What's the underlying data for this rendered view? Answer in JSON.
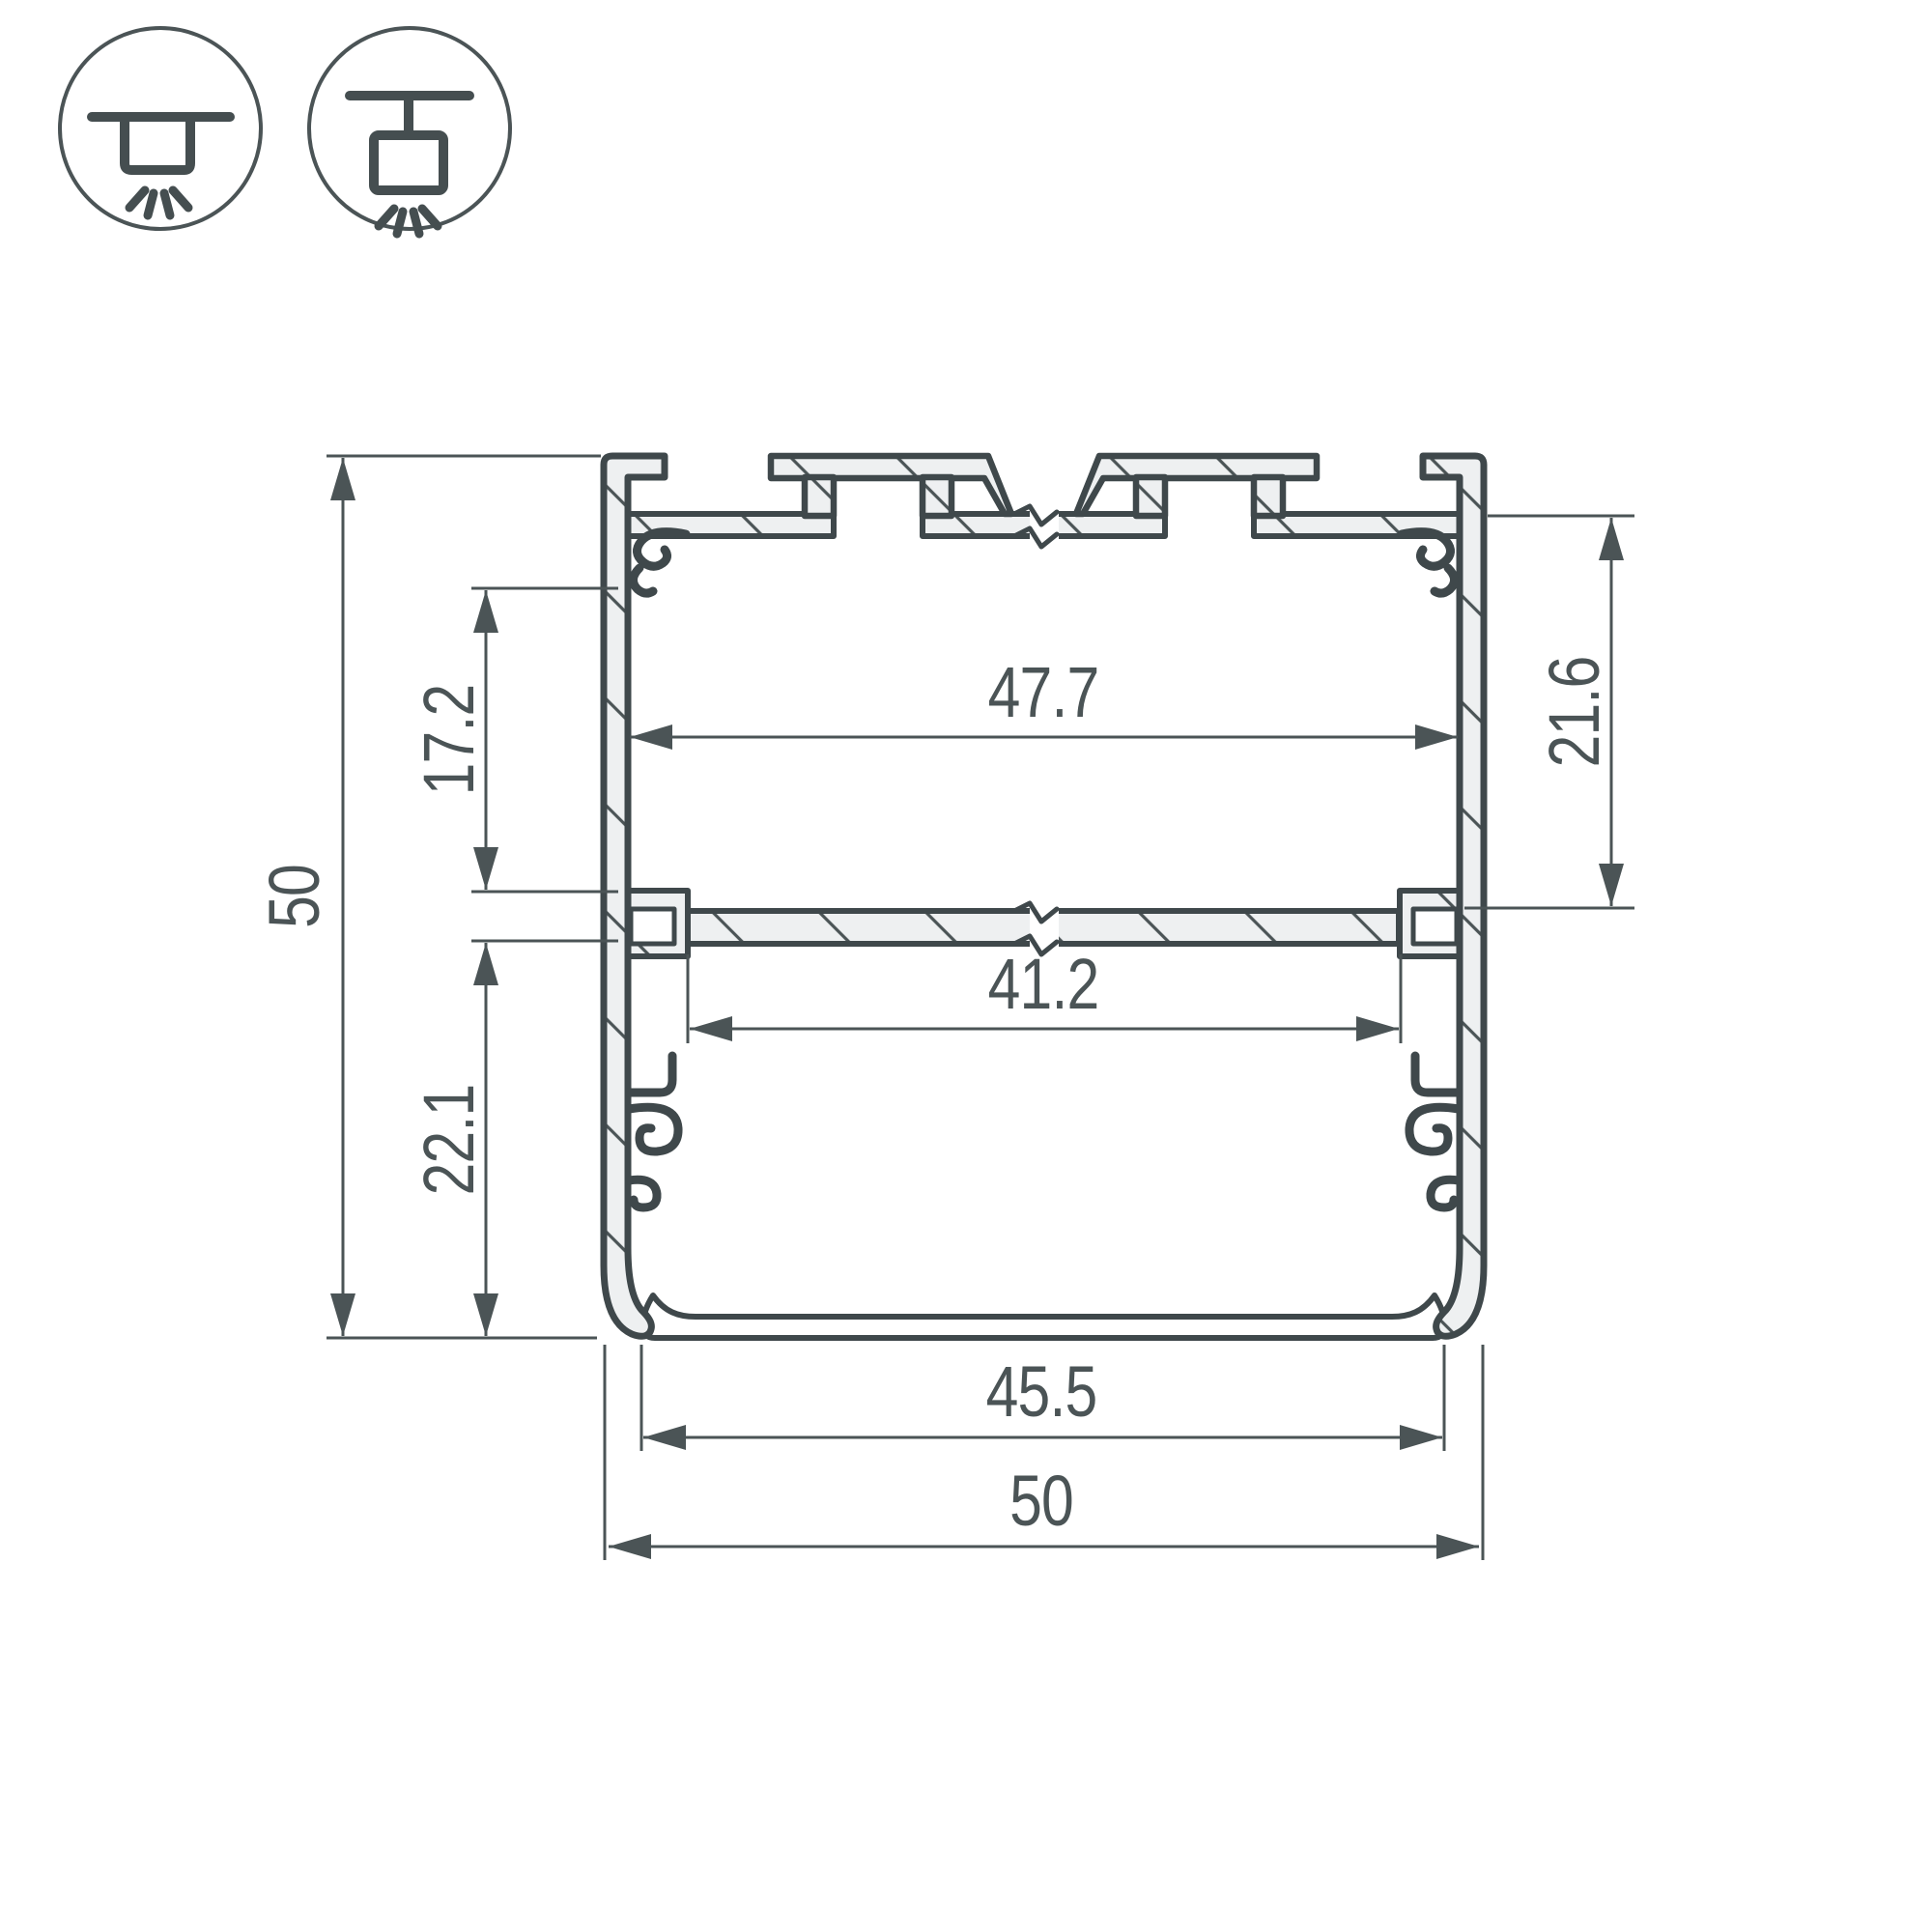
{
  "title": "LED profile cross-section technical drawing",
  "icons": {
    "surface_mount": "surface-mount-luminaire",
    "pendant_mount": "pendant-mount-luminaire"
  },
  "dimensions": {
    "overall_height": "50",
    "upper_inner_height": "17.2",
    "lower_inner_height": "22.1",
    "top_inner_width": "47.7",
    "right_inner_height": "21.6",
    "mid_inner_width": "41.2",
    "bottom_opening_width": "45.5",
    "overall_width": "50"
  },
  "colors": {
    "line": "#4b5456",
    "outline": "#3f484b",
    "aluminum_fill": "#eef0f1",
    "background": "#ffffff"
  }
}
